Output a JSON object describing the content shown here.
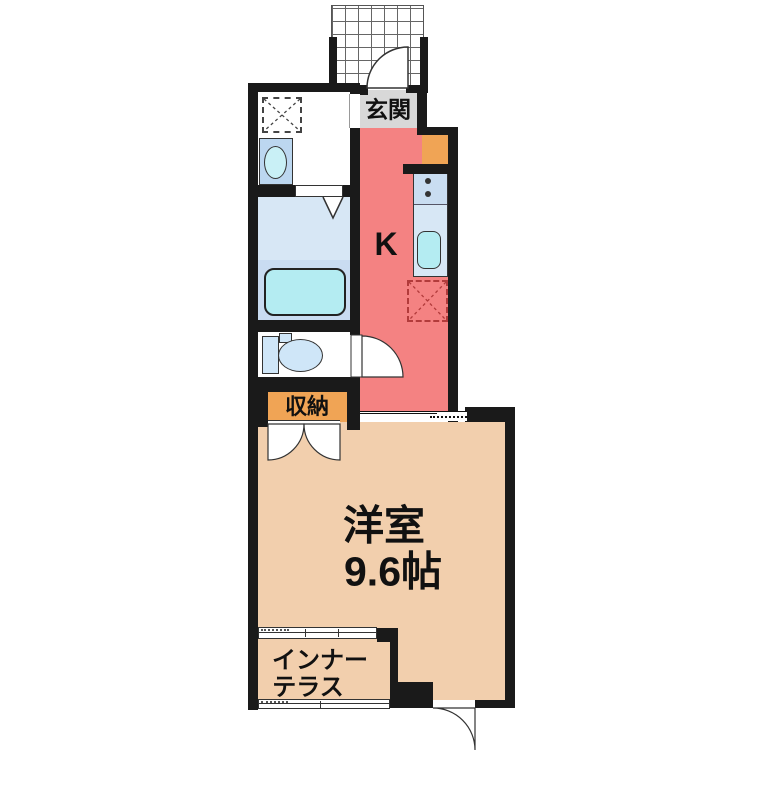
{
  "plan": {
    "type": "apartment-floor-plan",
    "labels": {
      "entrance": "玄関",
      "kitchen": "K",
      "storage": "収納",
      "room_name": "洋室",
      "room_size": "9.6帖",
      "terrace_line1": "インナー",
      "terrace_line2": "テラス"
    },
    "fixtures": {
      "porch": "entrance-porch-tiles",
      "washer": "washing-machine-space",
      "basin": "washbasin",
      "bathtub": "bathtub",
      "toilet": "toilet",
      "shoe_cabinet": "shoe-cabinet",
      "stove": "two-burner-stove",
      "kitchen_sink": "kitchen-sink",
      "refrigerator": "refrigerator-space"
    }
  },
  "colors": {
    "wall": "#1a1a1a",
    "kitchen_floor": "#f48282",
    "room_floor": "#f2cfad",
    "entrance_floor": "#d8d8d8",
    "storage_orange": "#f0a455",
    "bath_floor": "#d7e7f5",
    "bath_lower": "#c9dcf1",
    "tub_fill": "#b4ecf2",
    "fixture_blue": "#cfe6f8",
    "basin_box": "#bcd7f0",
    "basin_oval": "#c9f0f6",
    "counter_stove": "#c9ddf1",
    "counter_sink": "#d7e7f5",
    "fridge_dash": "#b23b3b",
    "line": "#333333"
  }
}
